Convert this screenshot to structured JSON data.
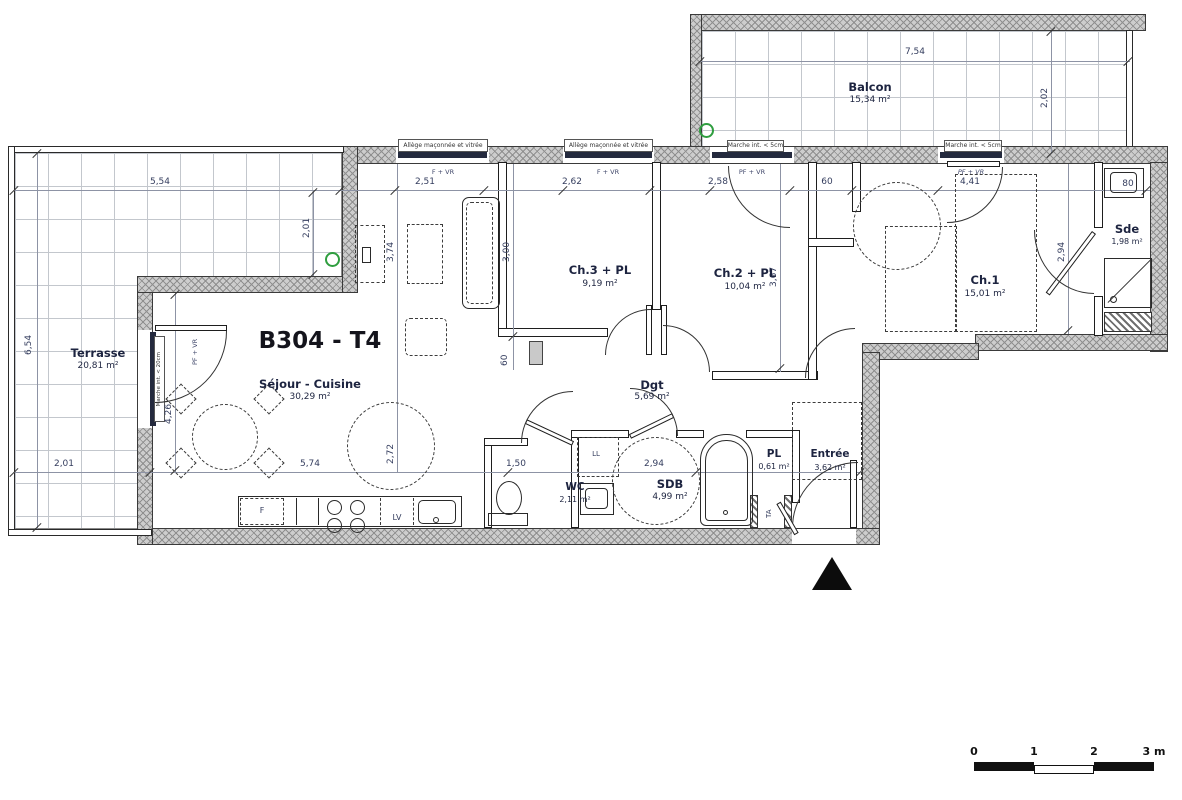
{
  "title": "B304 - T4",
  "rooms": {
    "balcon": {
      "name": "Balcon",
      "area": "15,34 m²"
    },
    "terrasse": {
      "name": "Terrasse",
      "area": "20,81 m²"
    },
    "sejour": {
      "name": "Séjour - Cuisine",
      "area": "30,29 m²"
    },
    "ch3": {
      "name": "Ch.3 + PL",
      "area": "9,19 m²"
    },
    "ch2": {
      "name": "Ch.2 + PL",
      "area": "10,04 m²"
    },
    "ch1": {
      "name": "Ch.1",
      "area": "15,01 m²"
    },
    "sde": {
      "name": "Sde",
      "area": "1,98 m²"
    },
    "dgt": {
      "name": "Dgt",
      "area": "5,69 m²"
    },
    "wc": {
      "name": "WC",
      "area": "2,11 m²"
    },
    "sdb": {
      "name": "SDB",
      "area": "4,99 m²"
    },
    "pl": {
      "name": "PL",
      "area": "0,61 m²"
    },
    "entree": {
      "name": "Entrée",
      "area": "3,62 m²"
    }
  },
  "dims": {
    "balcon_w": "7,54",
    "balcon_d": "2,02",
    "terrasse_w": "5,54",
    "terrasse_h": "6,54",
    "terrasse_d1": "2,01",
    "terrasse_d2": "2,01",
    "win1": "2,51",
    "win2": "2,62",
    "win3": "2,58",
    "duct": "60",
    "ch1_w": "4,41",
    "sink": "80",
    "sejour_d": "3,74",
    "ch3_d": "3,00",
    "ch3_niche": "60",
    "ch2_d": "3,67",
    "sde_d": "2,94",
    "sejour_h": "4,26",
    "circle": "2,72",
    "kitchen_w": "5,74",
    "wc_w": "1,50",
    "sdb_w": "2,94"
  },
  "tags": {
    "allege": "Allège maçonnée et vitrée",
    "marche5": "Marche int. < 5cm",
    "marche20": "Marche int. < 20cm",
    "fvr": "F + VR",
    "pfvr": "PF + VR",
    "ta": "TA",
    "ll": "LL",
    "fridge": "F",
    "lv": "LV"
  },
  "colors": {
    "wall": "#cdcdcd",
    "ink": "#1d2440",
    "green_marker": "#2f9e3f"
  },
  "scalebar": {
    "t0": "0",
    "t1": "1",
    "t2": "2",
    "t3": "3 m"
  }
}
